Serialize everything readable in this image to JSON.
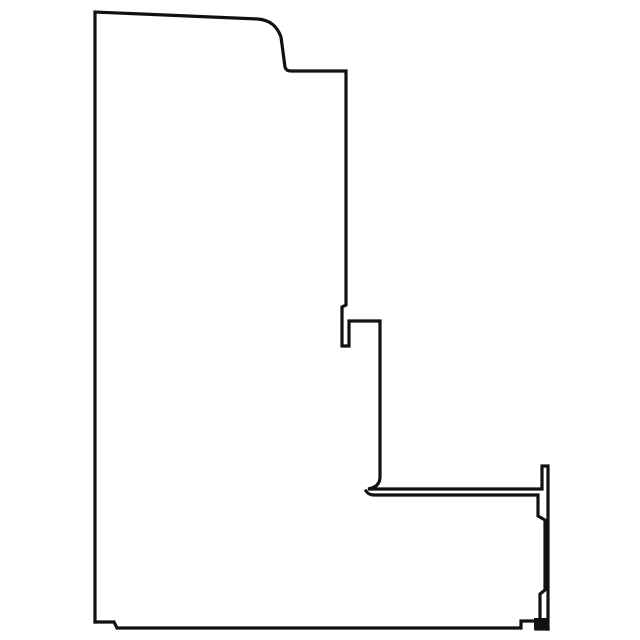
{
  "page": {
    "background_color": "#ffffff",
    "line_color": "#111111"
  },
  "drawing": {
    "name": "profile-cross-section-line-drawing",
    "canvas": {
      "width": 640,
      "height": 640
    },
    "paths": {
      "outline_main": "M 95 622 L 95 12 L 258 19 C 270 20 277 26 281 37 L 285 67 Q 286 71 291 71 L 346 71 L 346 305 L 342 307 L 342 346 L 349 346 L 349 321 L 380 321 L 380 477 Q 380 487 368 489 L 542 489 L 542 466 L 548 466 L 548 629",
      "bottom_edge": "M 95 622 L 114 622 L 117 628 L 521 628 L 521 621 L 536 621 L 536 629 L 548 629",
      "shelf_inner": "M 366 491 Q 368 495 374 495 L 538 495 L 538 516 L 545 520 L 545 590 L 540 594 L 540 618",
      "bottom_right_block": "M 534 618 L 549.5 618 L 549.5 629.5 L 534 629.5 Z"
    }
  }
}
